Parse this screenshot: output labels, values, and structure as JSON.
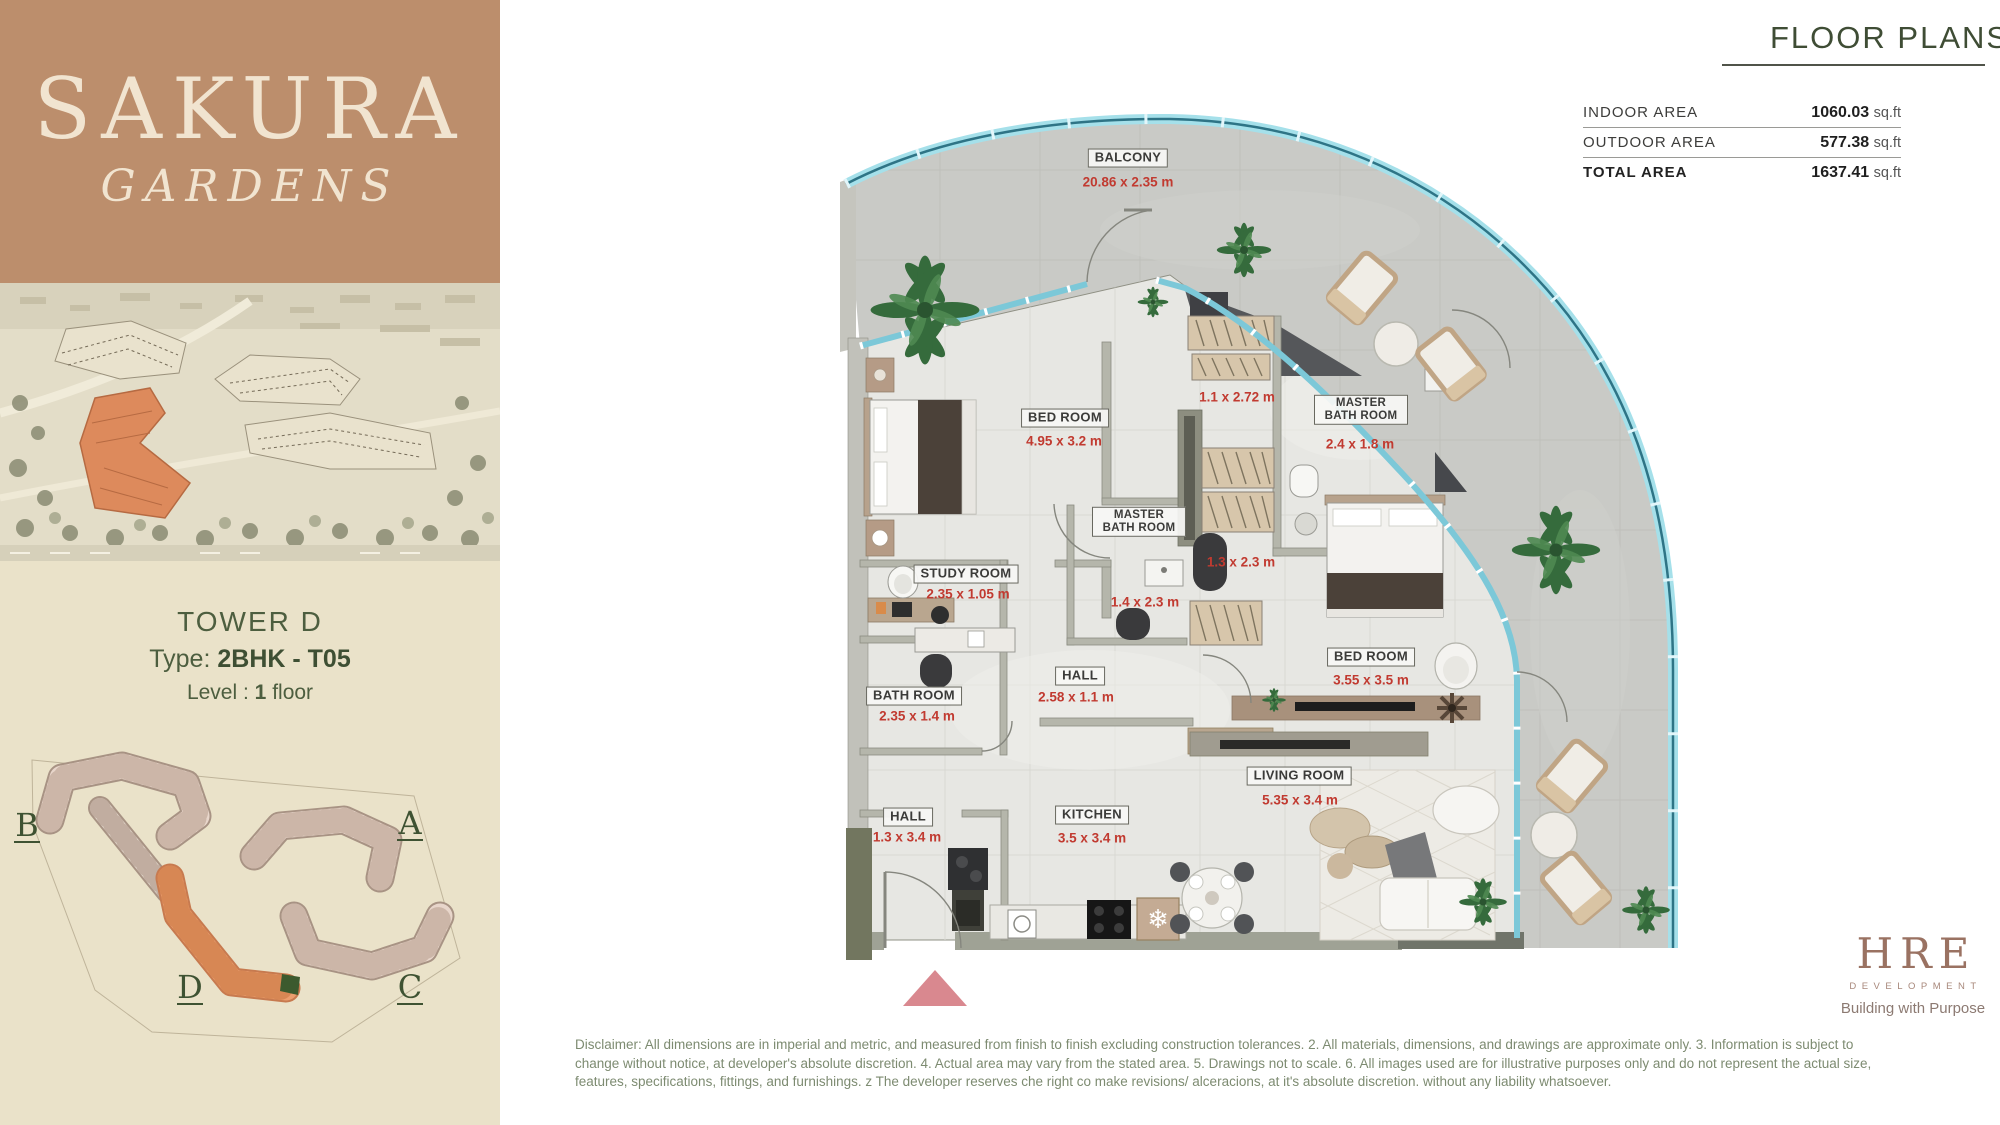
{
  "brand": {
    "title": "SAKURA",
    "subtitle": "GARDENS"
  },
  "tower": {
    "name": "TOWER D",
    "type_label": "Type:",
    "type_value": "2BHK - T05",
    "level_label": "Level :",
    "level_value": "1",
    "level_suffix": "floor"
  },
  "siteplan": {
    "label_a": "A",
    "label_b": "B",
    "label_c": "C",
    "label_d": "D"
  },
  "header": {
    "title": "FLOOR PLANS"
  },
  "areas": [
    {
      "label": "INDOOR AREA",
      "value": "1060.03",
      "unit": "sq.ft"
    },
    {
      "label": "OUTDOOR AREA",
      "value": "577.38",
      "unit": "sq.ft"
    },
    {
      "label": "TOTAL AREA",
      "value": "1637.41",
      "unit": "sq.ft"
    }
  ],
  "floorplan": {
    "rooms": [
      {
        "name": "BALCONY",
        "dim": "20.86 x 2.35 m"
      },
      {
        "name": "BED ROOM",
        "dim": "4.95 x 3.2 m"
      },
      {
        "name": "MASTER BATH ROOM",
        "dim": "2.4 x 1.8 m"
      },
      {
        "name": "MASTER BATH ROOM",
        "dim": ""
      },
      {
        "name": "STUDY ROOM",
        "dim": "2.35 x 1.05 m"
      },
      {
        "name": "BATH ROOM",
        "dim": "2.35 x 1.4 m"
      },
      {
        "name": "HALL",
        "dim": "2.58 x 1.1 m"
      },
      {
        "name": "HALL",
        "dim": "1.3 x 3.4 m"
      },
      {
        "name": "KITCHEN",
        "dim": "3.5 x 3.4 m"
      },
      {
        "name": "BED ROOM",
        "dim": "3.55 x 3.5 m"
      },
      {
        "name": "LIVING ROOM",
        "dim": "5.35 x 3.4 m"
      }
    ],
    "extra_dims": [
      "1.1 x 2.72 m",
      "1.3 x 2.3 m",
      "1.4 x 2.3 m"
    ]
  },
  "logo": {
    "name": "HRE",
    "division": "DEVELOPMENT",
    "tagline": "Building with Purpose"
  },
  "footer": {
    "disclaimer": "Disclaimer: All dimensions are in imperial and metric, and measured from finish to finish excluding construction tolerances. 2. All materials, dimensions, and drawings are approximate only. 3. Information is subject to change without notice, at developer's absolute discretion. 4. Actual area may vary from the stated area. 5. Drawings not to scale. 6. All images used are for illustrative purposes only and do not represent the actual size, features, specifications, fittings, and furnishings. z The developer reserves che right co make revisions/ alceracions, at it's absolute discretion. without any liability whatsoever."
  },
  "colors": {
    "brand_brown": "#bc8e6c",
    "heading_green": "#3f4d35",
    "dim_red": "#c13a30",
    "rail_teal": "#7fd0df",
    "site_orange": "#ec9e6f",
    "sidebar_cream": "#eae2c9"
  }
}
